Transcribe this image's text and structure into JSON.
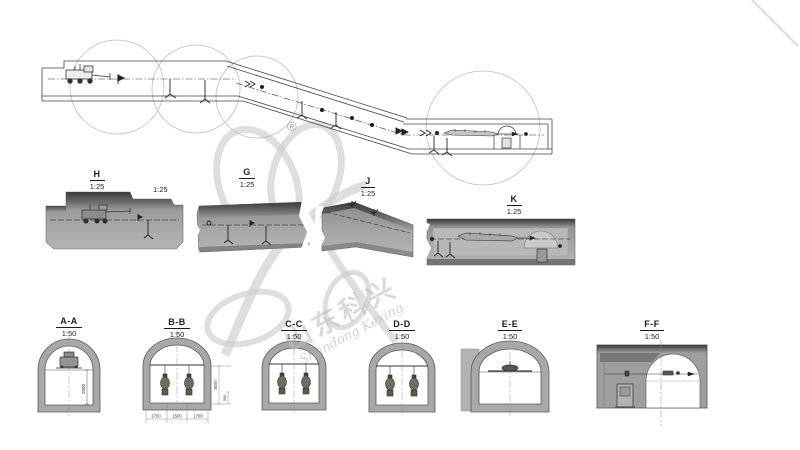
{
  "watermark": {
    "registered_mark": "®",
    "logo_text_cn": "山东科兴",
    "logo_text_en": "Shandong Kexing"
  },
  "plan_view": {
    "extra_scale_label": "1:25"
  },
  "detail_sections": [
    {
      "name": "H",
      "scale": "1:25"
    },
    {
      "name": "G",
      "scale": "1:25"
    },
    {
      "name": "J",
      "scale": "1:25"
    },
    {
      "name": "K",
      "scale": "1:25"
    }
  ],
  "cross_sections": [
    {
      "name": "A-A",
      "scale": "1:50"
    },
    {
      "name": "B-B",
      "scale": "1:50"
    },
    {
      "name": "C-C",
      "scale": "1:50"
    },
    {
      "name": "D-D",
      "scale": "1:50"
    },
    {
      "name": "E-E",
      "scale": "1:50"
    },
    {
      "name": "F-F",
      "scale": "1:50"
    }
  ],
  "dimensions": {
    "aa_height": "2000",
    "bb_right_upper": "3000",
    "bb_right_lower": "300",
    "bb_bottom_1": "1700",
    "bb_bottom_2": "1500",
    "bb_bottom_3": "1700"
  },
  "colors": {
    "background": "#ffffff",
    "linework": "#333333",
    "section_fill": "#a8a8a8",
    "top_shade": "#4a4a4a",
    "watermark": "#d7d7d7"
  }
}
